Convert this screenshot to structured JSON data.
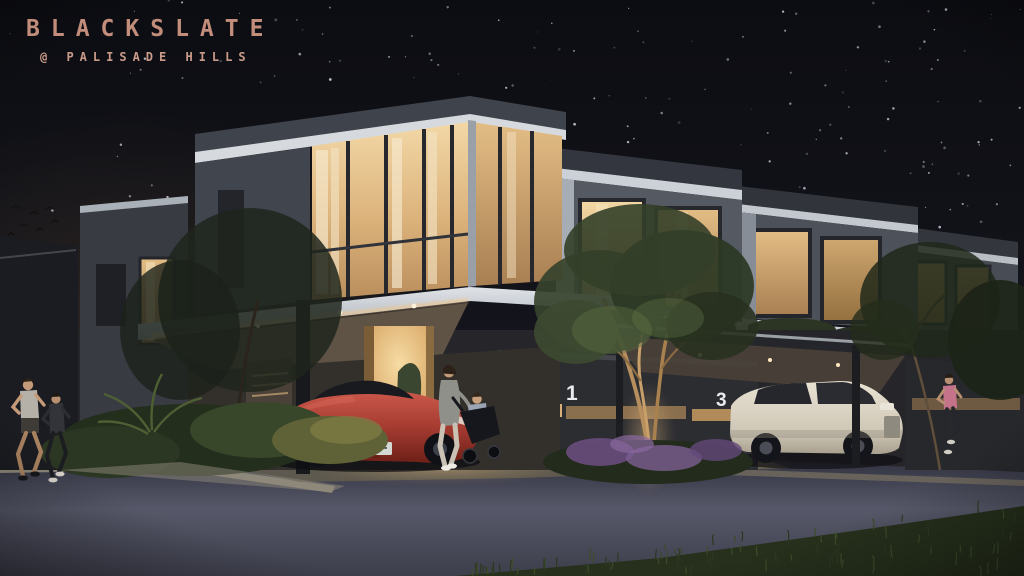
{
  "branding": {
    "name": "BLACKSLATE",
    "location": "@ PALISADE HILLS",
    "logo_color": "#c28e7b"
  },
  "units": {
    "left_label": "1",
    "right_label": "3"
  },
  "palette": {
    "sky_top": "#0e0f14",
    "sky_base": "#1a1b23",
    "sky_left_haze": "#342b23",
    "fascia_white": "#ced3d9",
    "facade_dark": "#3c3f47",
    "ground_wall_dark": "#2f2d2b",
    "glass_glow_bright": "#eecf9b",
    "glass_glow_dim": "#c49a66",
    "soffit_led": "#e8bd82",
    "door_glow": "#f1cd8e",
    "road_asphalt": "#3a3b49",
    "road_sheen": "#585969",
    "kerb_concrete": "#8c8679",
    "driveway_warm": "#8a7c61",
    "foliage_dark": "#2b3522",
    "foliage_lit": "#57683e",
    "flower_purple": "#7c5f92",
    "sports_car_red": "#b5473c",
    "suv_cream": "#ded7c8",
    "star_white": "#d3d9e6"
  }
}
